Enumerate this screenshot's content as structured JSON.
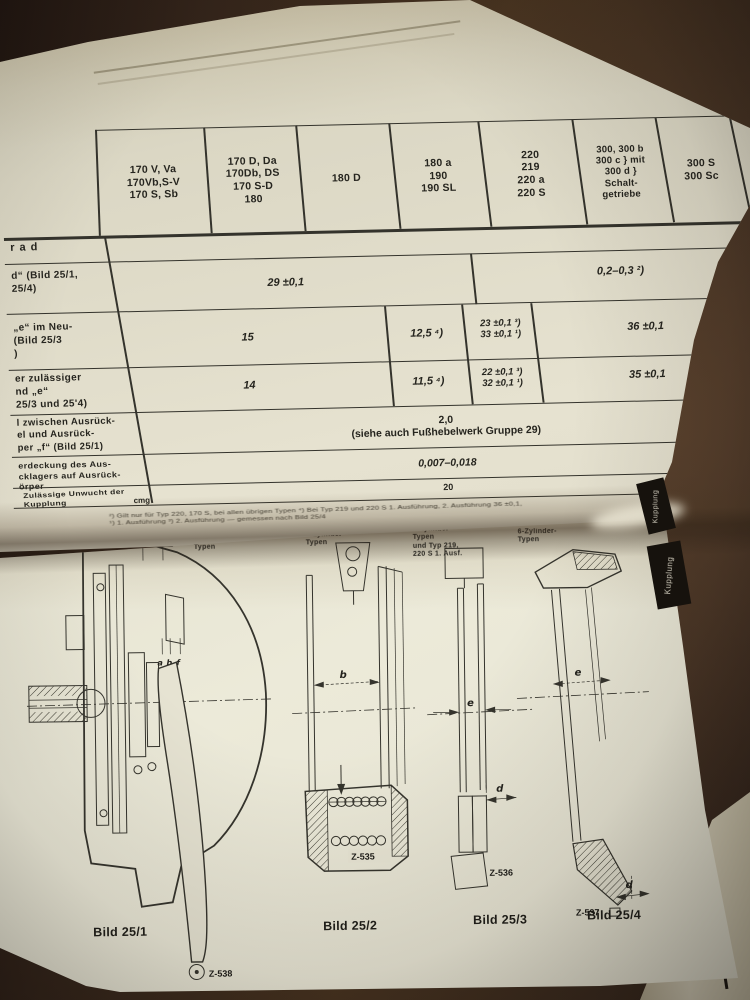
{
  "table": {
    "header_cols": [
      "170 V, Va\n170Vb,S-V\n170 S, Sb",
      "170 D, Da\n170Db, DS\n170 S-D\n180",
      "180 D",
      "180 a\n190\n190 SL",
      "220\n219\n220 a\n220 S",
      "300, 300 b\n300 c } mit\n300 d }\nSchalt-\ngetriebe",
      "300 S\n300 Sc",
      "3",
      "rad"
    ],
    "section_header": "rad",
    "row1": {
      "label": "d“ (Bild 25/1,\n25/4)",
      "v_main": "29 ±0,1",
      "v_right": "0,2–0,3 ²)"
    },
    "row2": {
      "label": "„e“ im Neu-\n(Bild 25/3\n)",
      "v1": "15",
      "v2": "12,5 ⁴)",
      "v3": "23 ±0,1 ³)\n33 ±0,1 ¹)",
      "v4": "36 ±0,1"
    },
    "row3": {
      "label": "er zulässiger\nnd „e“\n25/3 und 25'4)",
      "v1": "14",
      "v2": "11,5 ⁴)",
      "v3": "22 ±0,1 ³)\n32 ±0,1 ¹)",
      "v4": "35 ±0,1"
    },
    "row4": {
      "label": "l zwischen Ausrück-\nel und Ausrück-\nper „f“ (Bild 25/1)",
      "value": "2,0\n(siehe auch Fußhebelwerk Gruppe 29)"
    },
    "row5": {
      "label": "erdeckung des Aus-\ncklagers auf Ausrück-\nörper",
      "value": "0,007–0,018"
    },
    "row6": {
      "label": "Zulässige Unwucht der\nKupplung",
      "unit": "cmg",
      "value": "20"
    },
    "footnote_line1": "²) Gilt nur für Typ 220, 170 S, bei allen übrigen Typen    ⁴) Bei Typ 219 und 220 S 1. Ausführung, 2. Ausführung 36 ±0,1,",
    "footnote_line2": "¹) 1. Ausführung    ³) 2. Ausführung — gemessen nach Bild 25/4"
  },
  "figures": [
    {
      "top_label": "4-Zylinder-\nTypen",
      "caption": "Bild 25/1",
      "ref": "Z-538",
      "dim_a": "a",
      "dim_b": "b",
      "dim_f": "f"
    },
    {
      "top_label": "6-Zylinder-\nTypen",
      "caption": "Bild 25/2",
      "ref": "Z-535",
      "dim_b": "b"
    },
    {
      "top_label": "6-Zylinder-\nTypen\nund Typ 219,\n220 S 1. Ausf.",
      "caption": "Bild 25/3",
      "ref": "Z-536",
      "dim_e": "e",
      "dim_d": "d"
    },
    {
      "top_label": "6-Zylinder-\nTypen",
      "caption": "Bild 25/4",
      "ref": "Z-537",
      "dim_e": "e",
      "dim_d": "d"
    }
  ],
  "margin": {
    "tab_upper": "Kupplung",
    "tab_lower": "Kupplung",
    "corner": "Gruppe"
  }
}
